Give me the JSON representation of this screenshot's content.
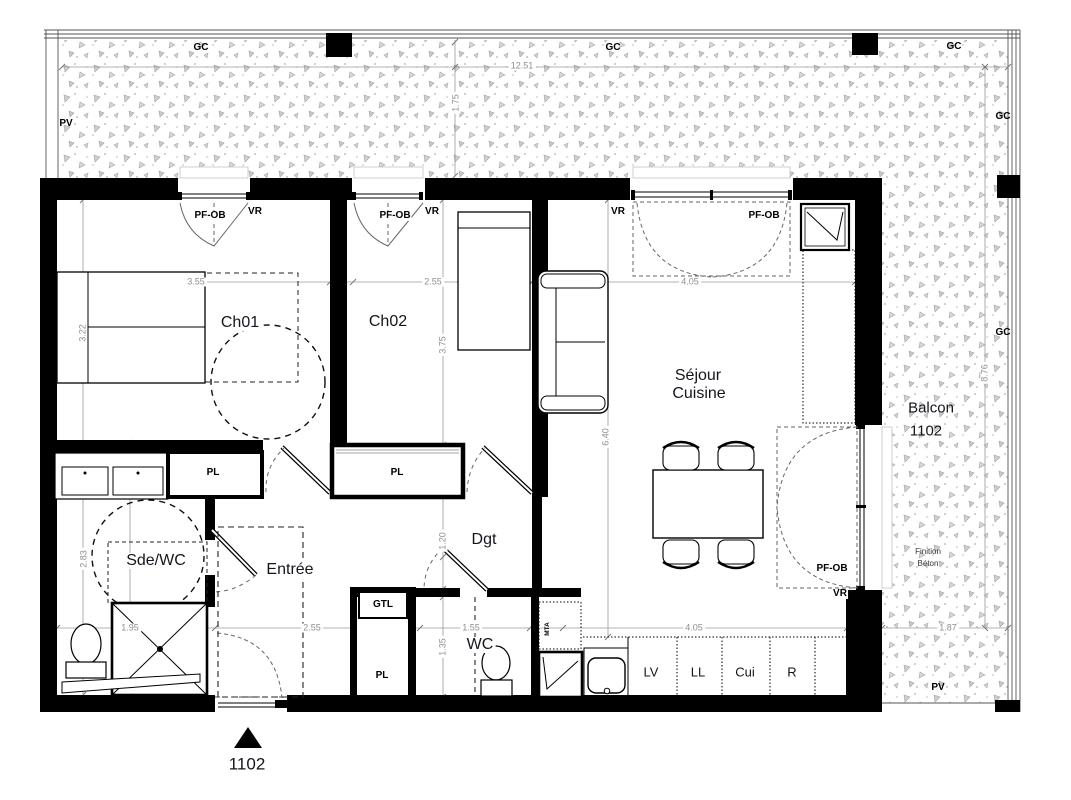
{
  "title": "Plan appartement 1102",
  "colors": {
    "wall": "#000000",
    "dim_line": "#999999",
    "stipple": "#b0b0b0",
    "text": "#15151d"
  },
  "legend": {
    "gc": "GC",
    "pv": "PV",
    "window": "PF-OB",
    "shutter": "VR",
    "closet": "PL"
  },
  "balcony": {
    "label_line1": "Balcon",
    "label_line2": "1102",
    "finish_line1": "Finition",
    "finish_line2": "Béton",
    "dim_width": "12.51",
    "dim_depth": "1.75",
    "dim_length_right": "8.76",
    "dim_depth_bottom": "1.87"
  },
  "rooms": {
    "ch01": {
      "name": "Ch01",
      "dim_w": "3.55",
      "dim_h": "3.22"
    },
    "ch02": {
      "name": "Ch02",
      "dim_w": "2.55",
      "dim_h": "3.75"
    },
    "sejour": {
      "name_line1": "Séjour",
      "name_line2": "Cuisine",
      "dim_w": "4.05",
      "dim_h": "6.40"
    },
    "sde_wc": {
      "name": "Sde/WC",
      "dim_w": "1.95",
      "dim_h": "2.83"
    },
    "entree": {
      "name": "Entrée",
      "dim_w": "2.55"
    },
    "dgt": {
      "name": "Dgt",
      "dim_w": "1.20"
    },
    "wc": {
      "name": "WC",
      "dim_w": "1.55",
      "dim_h": "1.35"
    },
    "kitchen": {
      "dim_w": "4.05",
      "technical_box": "GTL",
      "duct": "MTA",
      "appliances": [
        "LV",
        "LL",
        "Cui",
        "R"
      ]
    }
  },
  "unit_marker": "1102"
}
